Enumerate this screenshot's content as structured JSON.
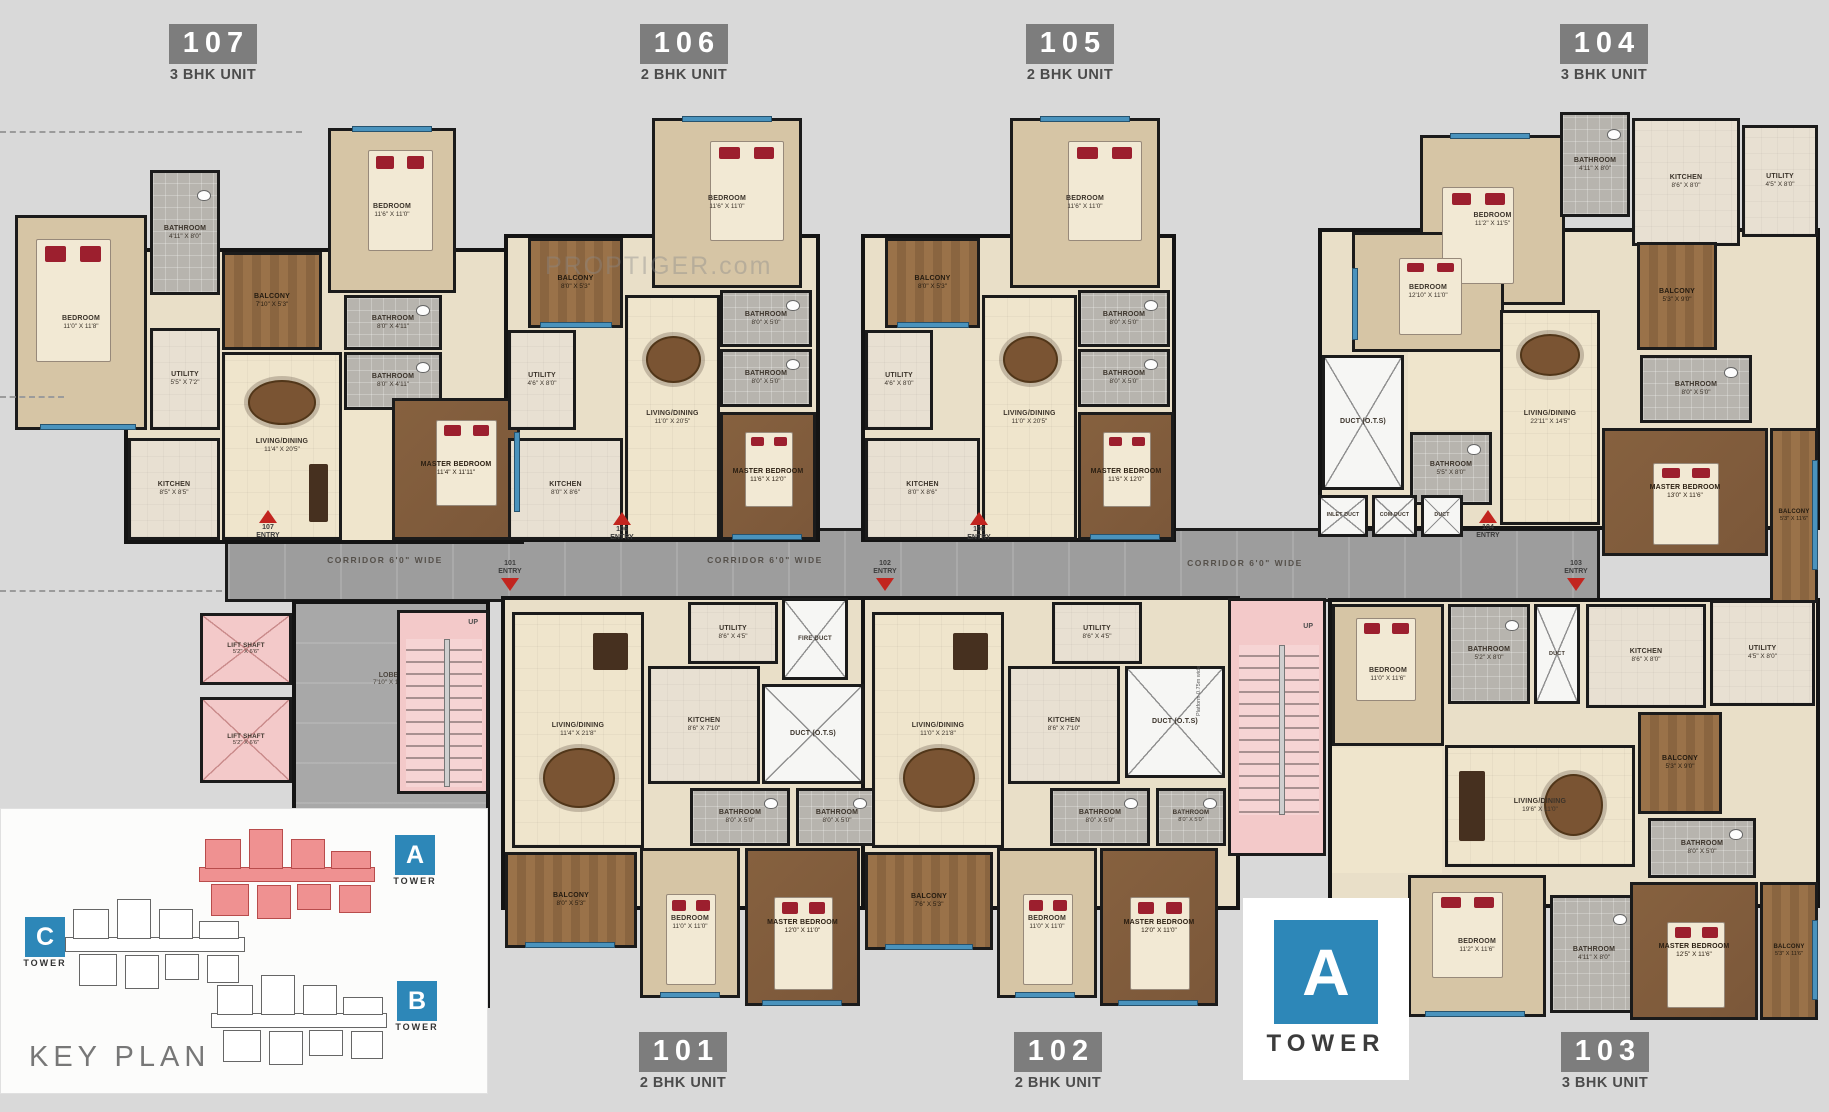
{
  "watermark": "PROPTIGER.com",
  "colors": {
    "accent_blue": "#2d87b8",
    "entry_red": "#c2251f",
    "tower_a_fill": "#ef9191",
    "corridor_gray": "#9d9d9d",
    "core_pink": "#f3c9c9",
    "floor_cream": "#efe5cc",
    "wall_black": "#1b1b1b"
  },
  "core": {
    "corridor_label": "CORRIDOR 6'0\" WIDE",
    "entry_word": "ENTRY",
    "lobby": {
      "name": "LOBBY",
      "dim": "7'10\" X 19'0\""
    },
    "lift": {
      "name": "LIFT SHAFT",
      "dim": "5'2\" X 6'6\""
    },
    "stairs_up": "UP",
    "platform": "Platform 0.75m wide"
  },
  "key_plan": {
    "title": "KEY PLAN",
    "towers": [
      {
        "letter": "A",
        "word": "TOWER"
      },
      {
        "letter": "B",
        "word": "TOWER"
      },
      {
        "letter": "C",
        "word": "TOWER"
      }
    ]
  },
  "tower_badge": {
    "letter": "A",
    "word": "TOWER"
  },
  "units": [
    {
      "id": "107",
      "type": "3 BHK UNIT",
      "rooms": [
        {
          "name": "BEDROOM",
          "dim": "11'0\" X 11'8\""
        },
        {
          "name": "BATHROOM",
          "dim": "4'11\" X 8'0\""
        },
        {
          "name": "BALCONY",
          "dim": "7'10\" X 5'3\""
        },
        {
          "name": "BEDROOM",
          "dim": "11'6\" X 11'0\""
        },
        {
          "name": "BATHROOM",
          "dim": "8'0\" X 4'11\""
        },
        {
          "name": "BATHROOM",
          "dim": "8'0\" X 4'11\""
        },
        {
          "name": "UTILITY",
          "dim": "5'5\" X 7'2\""
        },
        {
          "name": "KITCHEN",
          "dim": "8'5\" X 8'5\""
        },
        {
          "name": "LIVING/DINING",
          "dim": "11'4\" X 20'5\""
        },
        {
          "name": "MASTER BEDROOM",
          "dim": "11'4\" X 11'11\""
        }
      ]
    },
    {
      "id": "106",
      "type": "2 BHK UNIT",
      "rooms": [
        {
          "name": "BEDROOM",
          "dim": "11'6\" X 11'0\""
        },
        {
          "name": "BALCONY",
          "dim": "8'0\" X 5'3\""
        },
        {
          "name": "BATHROOM",
          "dim": "8'0\" X 5'0\""
        },
        {
          "name": "BATHROOM",
          "dim": "8'0\" X 5'0\""
        },
        {
          "name": "UTILITY",
          "dim": "4'6\" X 8'0\""
        },
        {
          "name": "KITCHEN",
          "dim": "8'0\" X 8'6\""
        },
        {
          "name": "LIVING/DINING",
          "dim": "11'0\" X 20'5\""
        },
        {
          "name": "MASTER BEDROOM",
          "dim": "11'6\" X 12'0\""
        }
      ]
    },
    {
      "id": "105",
      "type": "2 BHK UNIT",
      "rooms": [
        {
          "name": "BEDROOM",
          "dim": "11'6\" X 11'0\""
        },
        {
          "name": "BALCONY",
          "dim": "8'0\" X 5'3\""
        },
        {
          "name": "BATHROOM",
          "dim": "8'0\" X 5'0\""
        },
        {
          "name": "BATHROOM",
          "dim": "8'0\" X 5'0\""
        },
        {
          "name": "UTILITY",
          "dim": "4'6\" X 8'0\""
        },
        {
          "name": "KITCHEN",
          "dim": "8'0\" X 8'6\""
        },
        {
          "name": "LIVING/DINING",
          "dim": "11'0\" X 20'5\""
        },
        {
          "name": "MASTER BEDROOM",
          "dim": "11'6\" X 12'0\""
        }
      ]
    },
    {
      "id": "104",
      "type": "3 BHK UNIT",
      "rooms": [
        {
          "name": "BEDROOM",
          "dim": "11'2\" X 11'5\""
        },
        {
          "name": "BATHROOM",
          "dim": "4'11\" X 8'0\""
        },
        {
          "name": "KITCHEN",
          "dim": "8'6\" X 8'0\""
        },
        {
          "name": "UTILITY",
          "dim": "4'5\" X 8'0\""
        },
        {
          "name": "BEDROOM",
          "dim": "12'10\" X 11'0\""
        },
        {
          "name": "BALCONY",
          "dim": "5'3\" X 9'0\""
        },
        {
          "name": "LIVING/DINING",
          "dim": "22'11\" X 14'5\""
        },
        {
          "name": "BATHROOM",
          "dim": "8'0\" X 5'0\""
        },
        {
          "name": "BATHROOM",
          "dim": "5'5\" X 8'0\""
        },
        {
          "name": "DUCT (O.T.S)",
          "dim": ""
        },
        {
          "name": "MASTER BEDROOM",
          "dim": "13'0\" X 11'6\""
        },
        {
          "name": "BALCONY",
          "dim": "5'3\" X 11'6\""
        },
        {
          "name": "INLET DUCT",
          "dim": ""
        },
        {
          "name": "COM DUCT",
          "dim": ""
        },
        {
          "name": "DUCT",
          "dim": ""
        }
      ]
    },
    {
      "id": "101",
      "type": "2 BHK UNIT",
      "rooms": [
        {
          "name": "UTILITY",
          "dim": "8'6\" X 4'5\""
        },
        {
          "name": "KITCHEN",
          "dim": "8'6\" X 7'10\""
        },
        {
          "name": "LIVING/DINING",
          "dim": "11'4\" X 21'8\""
        },
        {
          "name": "FIRE DUCT",
          "dim": ""
        },
        {
          "name": "DUCT (O.T.S)",
          "dim": ""
        },
        {
          "name": "BATHROOM",
          "dim": "8'0\" X 5'0\""
        },
        {
          "name": "BATHROOM",
          "dim": "8'0\" X 5'0\""
        },
        {
          "name": "BALCONY",
          "dim": "8'0\" X 5'3\""
        },
        {
          "name": "BEDROOM",
          "dim": "11'0\" X 11'0\""
        },
        {
          "name": "MASTER BEDROOM",
          "dim": "12'0\" X 11'0\""
        }
      ]
    },
    {
      "id": "102",
      "type": "2 BHK UNIT",
      "rooms": [
        {
          "name": "UTILITY",
          "dim": "8'6\" X 4'5\""
        },
        {
          "name": "KITCHEN",
          "dim": "8'6\" X 7'10\""
        },
        {
          "name": "LIVING/DINING",
          "dim": "11'0\" X 21'8\""
        },
        {
          "name": "DUCT (O.T.S)",
          "dim": ""
        },
        {
          "name": "BATHROOM",
          "dim": "8'0\" X 5'0\""
        },
        {
          "name": "BATHROOM",
          "dim": "8'0\" X 5'0\""
        },
        {
          "name": "BALCONY",
          "dim": "7'6\" X 5'3\""
        },
        {
          "name": "BEDROOM",
          "dim": "11'0\" X 11'0\""
        },
        {
          "name": "MASTER BEDROOM",
          "dim": "12'0\" X 11'0\""
        }
      ]
    },
    {
      "id": "103",
      "type": "3 BHK UNIT",
      "rooms": [
        {
          "name": "BEDROOM",
          "dim": "11'0\" X 11'6\""
        },
        {
          "name": "BATHROOM",
          "dim": "5'2\" X 8'0\""
        },
        {
          "name": "DUCT",
          "dim": ""
        },
        {
          "name": "KITCHEN",
          "dim": "8'6\" X 8'0\""
        },
        {
          "name": "UTILITY",
          "dim": "4'5\" X 8'0\""
        },
        {
          "name": "BALCONY",
          "dim": "5'3\" X 9'0\""
        },
        {
          "name": "LIVING/DINING",
          "dim": "19'6\" X 11'0\""
        },
        {
          "name": "BATHROOM",
          "dim": "8'0\" X 5'0\""
        },
        {
          "name": "BEDROOM",
          "dim": "11'2\" X 11'6\""
        },
        {
          "name": "BATHROOM",
          "dim": "4'11\" X 8'0\""
        },
        {
          "name": "MASTER BEDROOM",
          "dim": "12'5\" X 11'6\""
        },
        {
          "name": "BALCONY",
          "dim": "5'3\" X 11'6\""
        }
      ]
    }
  ]
}
